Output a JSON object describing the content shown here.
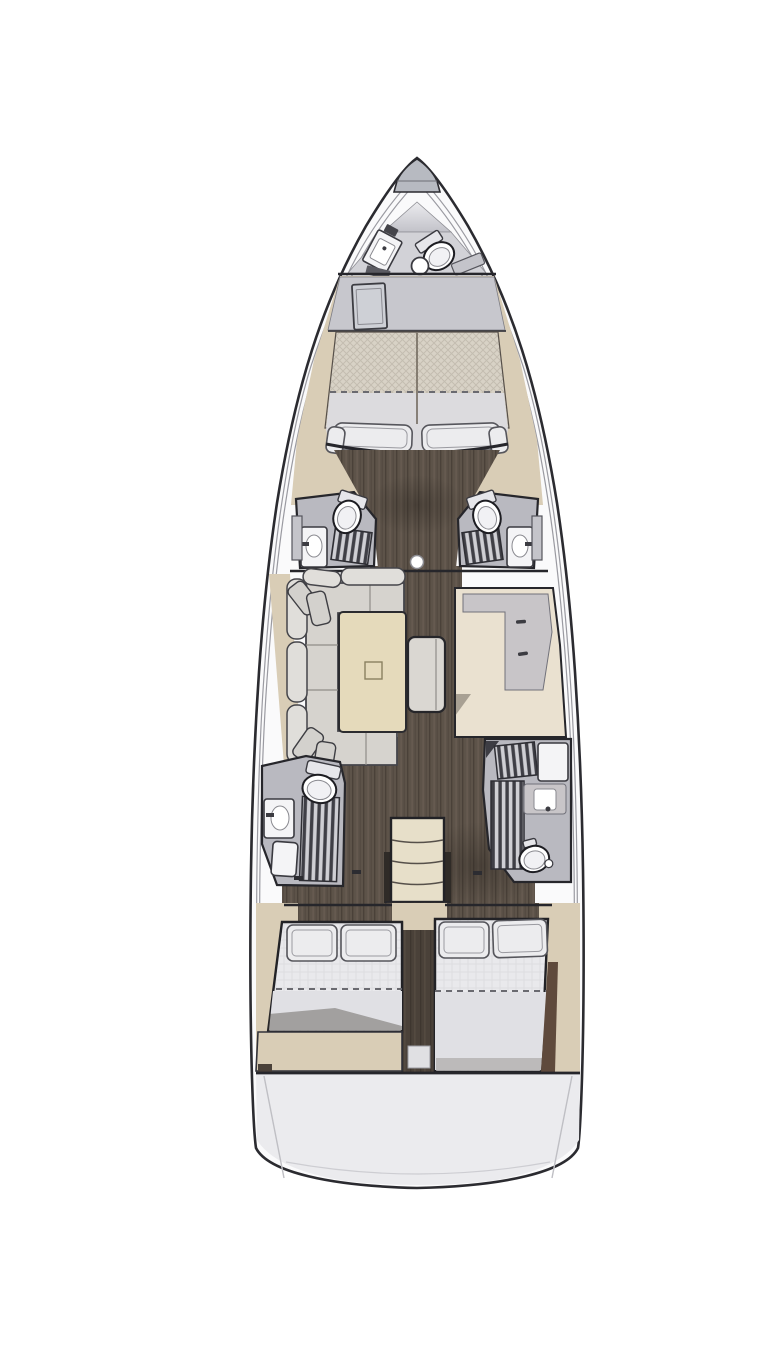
{
  "diagram": {
    "type": "yacht-interior-floor-plan",
    "view": "top-down",
    "orientation": "bow-up",
    "areas": [
      "anchor-locker",
      "bow-crew-head",
      "forward-cabin",
      "forward-head-port",
      "forward-head-starboard",
      "saloon",
      "galley",
      "companionway",
      "aft-head-port",
      "aft-head-starboard",
      "aft-cabin-port",
      "aft-cabin-starboard",
      "stern-platform"
    ],
    "fixtures": {
      "toilets": 5,
      "sinks": 5,
      "shower-grates": 4,
      "double-berths": 3,
      "sofa": 1,
      "saloon-table": 1,
      "ottoman": 1,
      "mast-post": 1,
      "companionway-treads": 4
    }
  },
  "colors": {
    "background": "#ffffff",
    "hull_outline": "#2b2b30",
    "hull_fill": "#fafafb",
    "deck_line": "#9a9aa1",
    "bow_cap": "#b7bac1",
    "cone_top": "#ececef",
    "cone_bottom": "#c2c2c9",
    "head_area": "#d2d2d7",
    "platform": "#c7c7cd",
    "locker": "#ced0d6",
    "tan": "#d9cdb6",
    "mattress_fwd": "#d8d2c6",
    "sheet": "#dcdbde",
    "pillow": "#ececee",
    "pillow_stroke": "#56565c",
    "wood": "#5d5349",
    "wood_light": "#6d6257",
    "wood_dark": "#4a4139",
    "head_floor": "#b9b9c0",
    "head_stroke": "#26262b",
    "toilet": "#ffffff",
    "grate_light": "#cfcfd4",
    "grate_dark": "#3f3f46",
    "sink": "#f4f4f6",
    "sofa_seat": "#d6d3ce",
    "sofa_back": "#e0deda",
    "sofa_stroke": "#45454a",
    "table": "#e5dabb",
    "table_stroke": "#2b2b2f",
    "ottoman": "#dad7d2",
    "galley": "#eae1d0",
    "counter": "#c8c5c8",
    "steps": "#e7dfc9",
    "hatch": "#e0e0e3",
    "bed": "#e9e9ec",
    "blanket": "#e0e0e4",
    "stern": "#ebebee",
    "brown": "#5f4a3c"
  }
}
